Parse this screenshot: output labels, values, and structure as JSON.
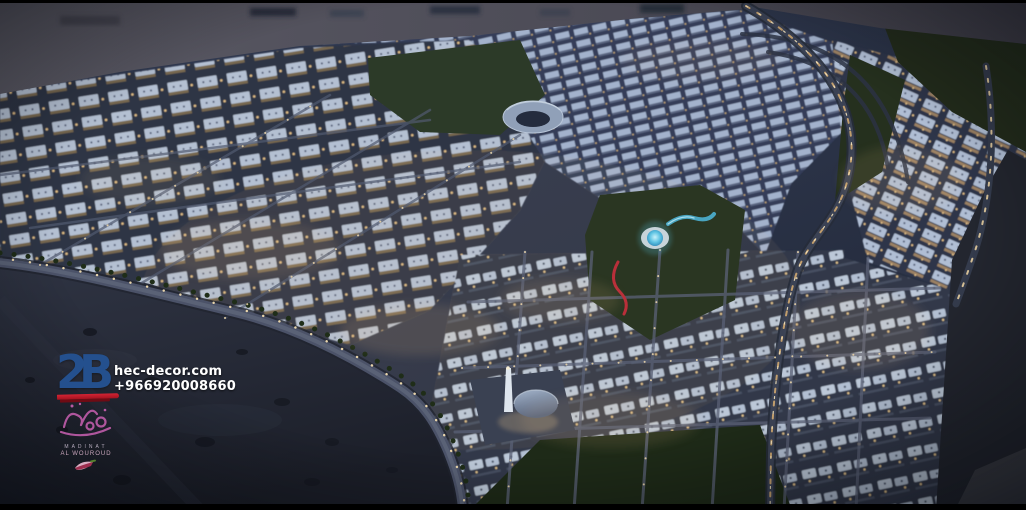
{
  "watermark": {
    "logo_text": "2B",
    "website": "hec-decor.com",
    "phone": "+966920008660",
    "project": {
      "name_line1": "MADINAT",
      "name_line2": "AL WOUROUD"
    },
    "colors": {
      "logo_blue": "#24508e",
      "swoosh_red": "#c21a28",
      "contact_text": "#ffffff",
      "calligraphy_magenta": "#b85aa4"
    }
  },
  "scene": {
    "setting": "Aerial dusk render of a residential city masterplan surrounded by desert",
    "landmarks": [
      "desert-foreground",
      "perimeter-road",
      "main-artery-road",
      "circular-plaza",
      "blue-lit-fountain",
      "mosque-dome",
      "central-park",
      "villa-grid-district"
    ],
    "palette": {
      "sky_desert_band": "#53525f",
      "city_rooftops": "#aebdd2",
      "warm_window_light": "#e7c287",
      "road_gray": "#4b5268",
      "park_green": "#2b3823",
      "fountain_blue": "#4fb9dd",
      "desert_dark": "#262a37",
      "letterbox_black": "#000000"
    }
  }
}
